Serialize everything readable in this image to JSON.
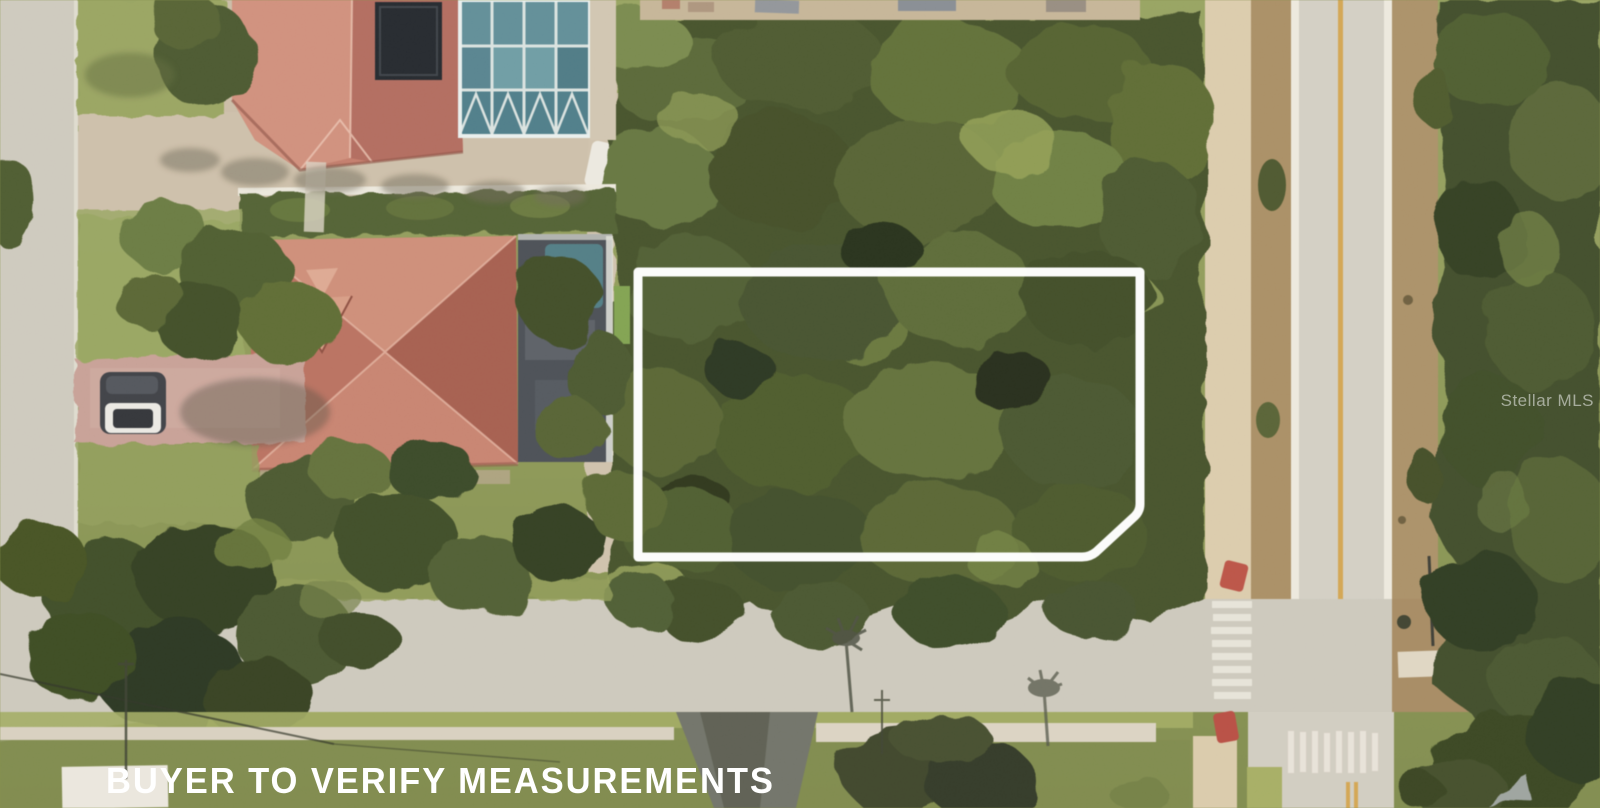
{
  "photo": {
    "kind": "satellite-aerial-view",
    "subject": "vacant wooded corner lot outlined in white next to tile-roof homes and a street intersection"
  },
  "overlay": {
    "caption": "BUYER TO VERIFY MEASUREMENTS",
    "watermark": "Stellar MLS"
  },
  "colors": {
    "boundary_outline": "#ffffff",
    "caption_text": "#ffffff",
    "woods_green": "#46512a",
    "grass_green": "#8b9553",
    "asphalt_gray": "#cdc8bb",
    "sidewalk_beige": "#d9c8a8",
    "dirt_brown": "#a98e63",
    "roof_terracotta": "#c0735f",
    "pool_screen_teal": "#53808b",
    "pool_water_teal": "#4d7a82",
    "driveway_pink": "#c69b90",
    "center_line_yellow": "#d2a24c",
    "curb_red": "#bb4f41"
  }
}
